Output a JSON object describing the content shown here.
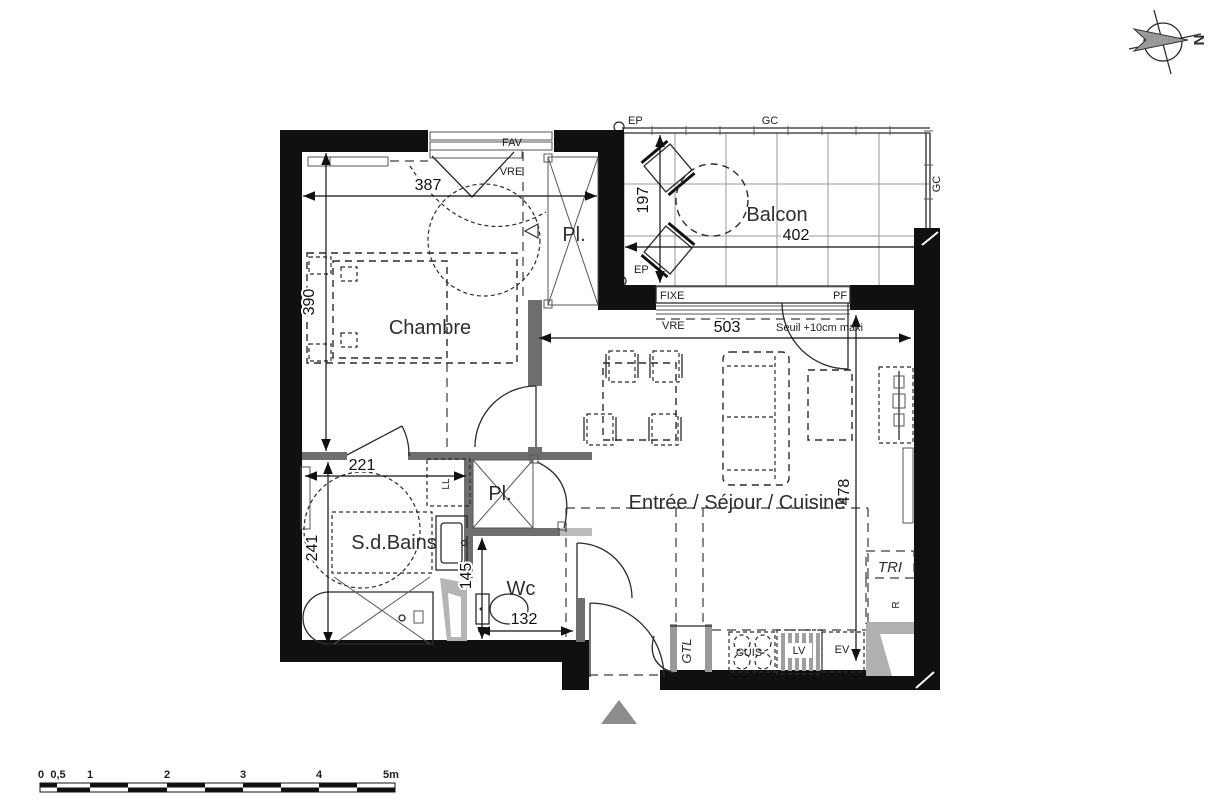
{
  "colors": {
    "wall": "#101010",
    "line": "#2b2b2b",
    "counter_gray": "#b3b3b3",
    "marker_gray": "#8c8c8c",
    "text": "#2e2e2e"
  },
  "rooms": {
    "chambre": "Chambre",
    "balcon": "Balcon",
    "sdbains": "S.d.Bains",
    "wc": "Wc",
    "pl1": "Pl.",
    "pl2": "Pl.",
    "sejour": "Entrée / Séjour / Cuisine"
  },
  "dims": {
    "chambre_width": "387",
    "chambre_height": "390",
    "balcon_depth": "197",
    "balcon_width": "402",
    "sejour_width": "503",
    "sejour_height": "478",
    "sdb_width": "221",
    "sdb_height": "241",
    "wc_height": "145",
    "wc_width": "132"
  },
  "ann": {
    "fav": "FAV",
    "vre_chambre": "VRE",
    "vre_sejour": "VRE",
    "ep_haut": "EP",
    "ep_bas": "EP",
    "gc_haut": "GC",
    "gc_droite": "GC",
    "fixe": "FIXE",
    "pf": "PF",
    "seuil": "Seuil +10cm maxi",
    "tri": "TRI",
    "refrigerateur": "R",
    "gtl": "GTL",
    "cuisson": "CUIS",
    "lave_vaisselle": "LV",
    "evier": "EV",
    "lave_linge": "LL"
  },
  "compass": {
    "north": "N"
  },
  "scale_bar": {
    "labels": [
      "0",
      "0,5",
      "1",
      "2",
      "3",
      "4",
      "5m"
    ]
  }
}
